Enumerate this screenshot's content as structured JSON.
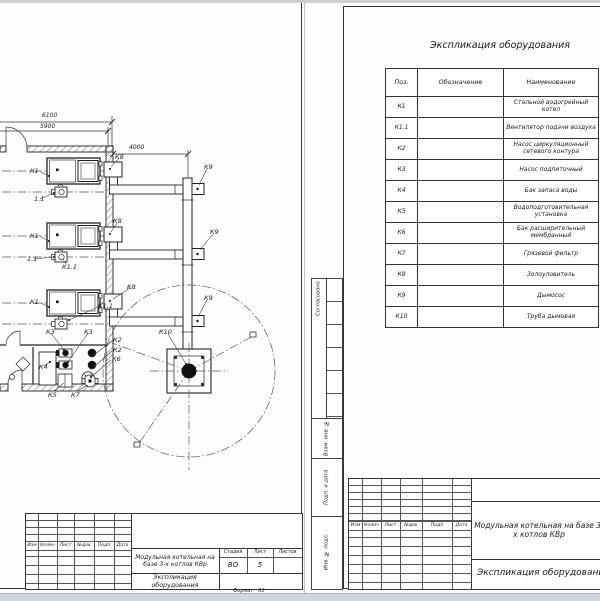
{
  "left_sheet": {
    "dims": {
      "overall": "6100",
      "inner": "5900",
      "flue": "4000"
    },
    "callouts": {
      "k1": "К1",
      "fan_short": "1.1",
      "k1_1": "К1.1",
      "k2": "К2",
      "k3": "К3",
      "k4": "К4",
      "k5": "К5",
      "k6": "К6",
      "k7": "К7",
      "k8": "К8",
      "k9": "К9",
      "k10": "К10"
    },
    "title_block": {
      "rev_cols": [
        "Изм",
        "Колич",
        "Лист",
        "№док",
        "Подп",
        "Дата"
      ],
      "project": "Модульная котельная на базе 3-х котлов КВр",
      "doc_title": "Экспликация оборудования",
      "stage_h": "Стадия",
      "sheet_h": "Лист",
      "sheets_h": "Листов",
      "stage": "ВО",
      "sheet_no": "5",
      "format_label": "Формат",
      "format_value": "А3"
    }
  },
  "right_sheet": {
    "title": "Экспликация оборудования",
    "table": {
      "headers": [
        "Поз.",
        "Обозначение",
        "Наименование"
      ],
      "rows": [
        {
          "pos": "К1",
          "name": "Стальной водогрейный котел"
        },
        {
          "pos": "К1.1",
          "name": "Вентилятор подачи воздуха"
        },
        {
          "pos": "К2",
          "name": "Насос циркуляционный сетевого контура"
        },
        {
          "pos": "К3",
          "name": "Насос подпиточный"
        },
        {
          "pos": "К4",
          "name": "Бак запаса воды"
        },
        {
          "pos": "К5",
          "name": "Водоподготовительная установка"
        },
        {
          "pos": "К6",
          "name": "Бак расширительный мембранный"
        },
        {
          "pos": "К7",
          "name": "Грязевой фильтр"
        },
        {
          "pos": "К8",
          "name": "Золоуловитель"
        },
        {
          "pos": "К9",
          "name": "Дымосос"
        },
        {
          "pos": "К10",
          "name": "Труба дымовая"
        }
      ]
    },
    "margin_cols": [
      "Согласовано",
      "Взам. инв. №",
      "Подп. и дата",
      "Инв. № подл."
    ],
    "title_block": {
      "rev_cols": [
        "Изм",
        "Колич",
        "Лист",
        "№док",
        "Подп",
        "Дата"
      ],
      "project": "Модульная котельная на базе 3-х котлов КВр",
      "doc_title": "Экспликация оборудования"
    }
  }
}
